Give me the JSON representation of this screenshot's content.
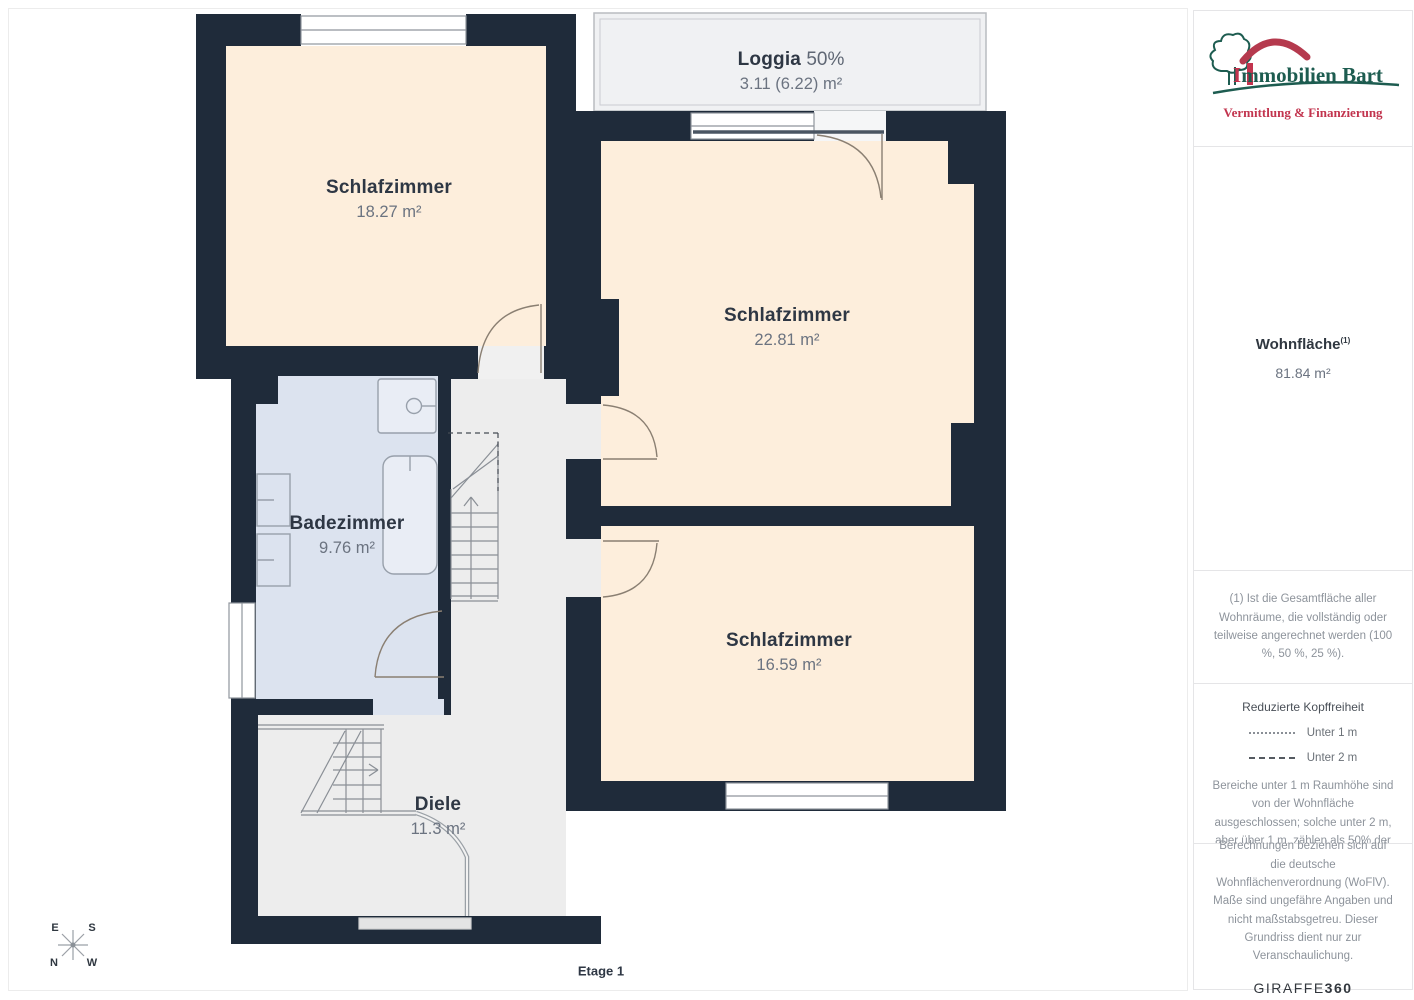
{
  "plan": {
    "floor_label": "Etage 1",
    "rooms": [
      {
        "id": "schlafzimmer-1",
        "name": "Schlafzimmer",
        "area": "18.27 m²"
      },
      {
        "id": "loggia",
        "name": "Loggia",
        "percent": "50%",
        "area": "3.11 (6.22) m²"
      },
      {
        "id": "schlafzimmer-2",
        "name": "Schlafzimmer",
        "area": "22.81 m²"
      },
      {
        "id": "badezimmer",
        "name": "Badezimmer",
        "area": "9.76 m²"
      },
      {
        "id": "schlafzimmer-3",
        "name": "Schlafzimmer",
        "area": "16.59 m²"
      },
      {
        "id": "diele",
        "name": "Diele",
        "area": "11.3 m²"
      }
    ],
    "compass": {
      "e": "E",
      "s": "S",
      "n": "N",
      "w": "W"
    }
  },
  "sidebar": {
    "logo": {
      "initial": "I",
      "rest": "mmobilien Bart",
      "subtitle": "Vermittlung & Finanzierung"
    },
    "summary": {
      "label": "Wohnfläche",
      "superscript": "(1)",
      "value": "81.84 m²"
    },
    "footnote": "(1) Ist die Gesamtfläche aller Wohnräume, die vollständig oder teilweise angerechnet werden (100 %, 50 %, 25 %).",
    "legend": {
      "title": "Reduzierte Kopffreiheit",
      "items": [
        {
          "style": "dotted",
          "label": "Unter 1 m"
        },
        {
          "style": "dashed",
          "label": "Unter 2 m"
        }
      ],
      "note": "Bereiche unter 1 m Raumhöhe sind von der Wohnfläche ausgeschlossen; solche unter 2 m, aber über 1 m, zählen als 50% der Wohnfläche"
    },
    "disclaimer": "Berechnungen beziehen sich auf die deutsche Wohnflächenverordnung (WoFlV). Maße sind ungefähre Angaben und nicht maßstabsgetreu. Dieser Grundriss dient nur zur Veranschaulichung.",
    "brand": {
      "name": "GIRAFFE",
      "suffix": "360"
    }
  },
  "colors": {
    "wall": "#1f2b3a",
    "bedroom_fill": "#fdeedc",
    "bath_fill": "#dce3ef",
    "hall_fill": "#ededed",
    "loggia_fill": "#f0f1f3",
    "logo_green": "#1d5c50",
    "logo_red": "#c2344e"
  }
}
